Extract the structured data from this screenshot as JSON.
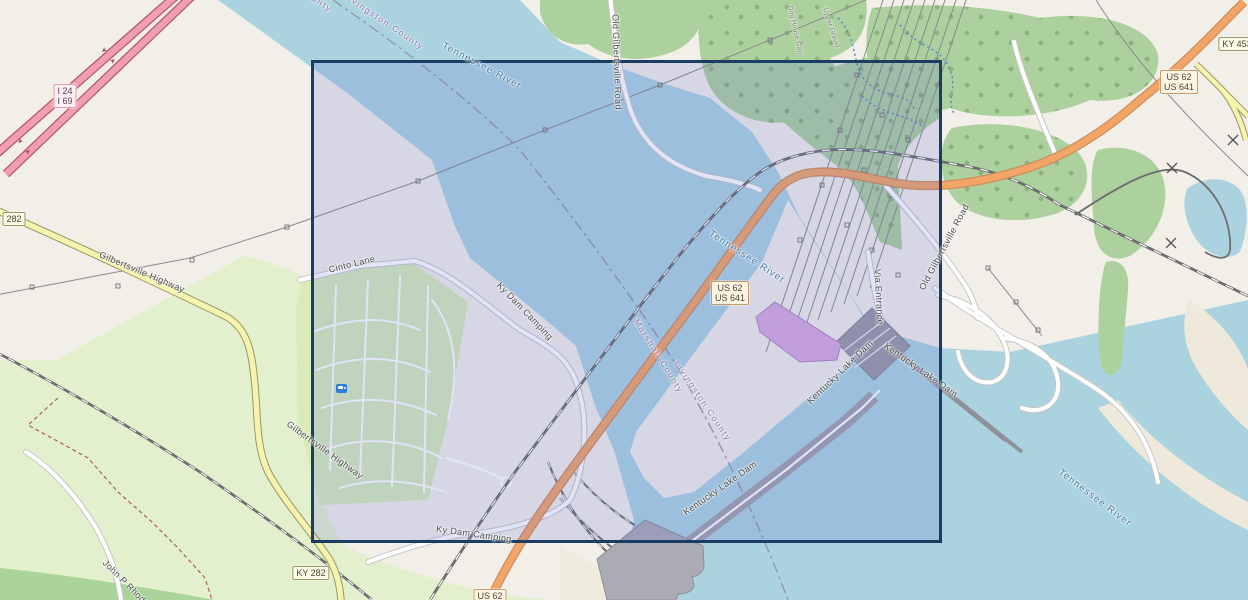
{
  "shields": {
    "interstate": {
      "line1": "I 24",
      "line2": "I 69"
    },
    "ref_282": "282",
    "ky_282": "KY 282",
    "us_62": "US 62",
    "us_62_641": {
      "line1": "US 62",
      "line2": "US 641"
    },
    "ky_453": "KY 453"
  },
  "road_labels": {
    "gilbertsville_highway": "Gilbertsville Highway",
    "old_gilbertsville_road": "Old Gilbertsville Road",
    "via_entrance": "Via Entrance",
    "ky_dam_camping": "Ky Dam Camping",
    "cinto_lane": "Cinto Lane",
    "kentucky_lake_dam": "Kentucky Lake Dam",
    "john_p_rhody": "John P Rhody",
    "dog_house_gap": "Dog House Gap",
    "upper_gravel": "Upper Gravel"
  },
  "water_labels": {
    "tennessee_river": "Tennessee River"
  },
  "county_labels": {
    "livingston": "Livingston County",
    "marshall": "Marshall County"
  },
  "icons": {
    "campsite": "campsite-icon"
  },
  "colors": {
    "land": "#f2efe9",
    "water": "#aad3df",
    "forest": "#add19e",
    "campground": "#d7ecb8",
    "park": "#e3f0cd",
    "motorway": "#ef9fae",
    "trunk": "#f2a567",
    "secondary_road": "#f5f3ae",
    "dam_gray": "#a2a2ab",
    "powerhouse": "#d7abdf",
    "selection_border": "#1b3c63",
    "selection_fill": "rgba(88,99,212,0.18)"
  }
}
